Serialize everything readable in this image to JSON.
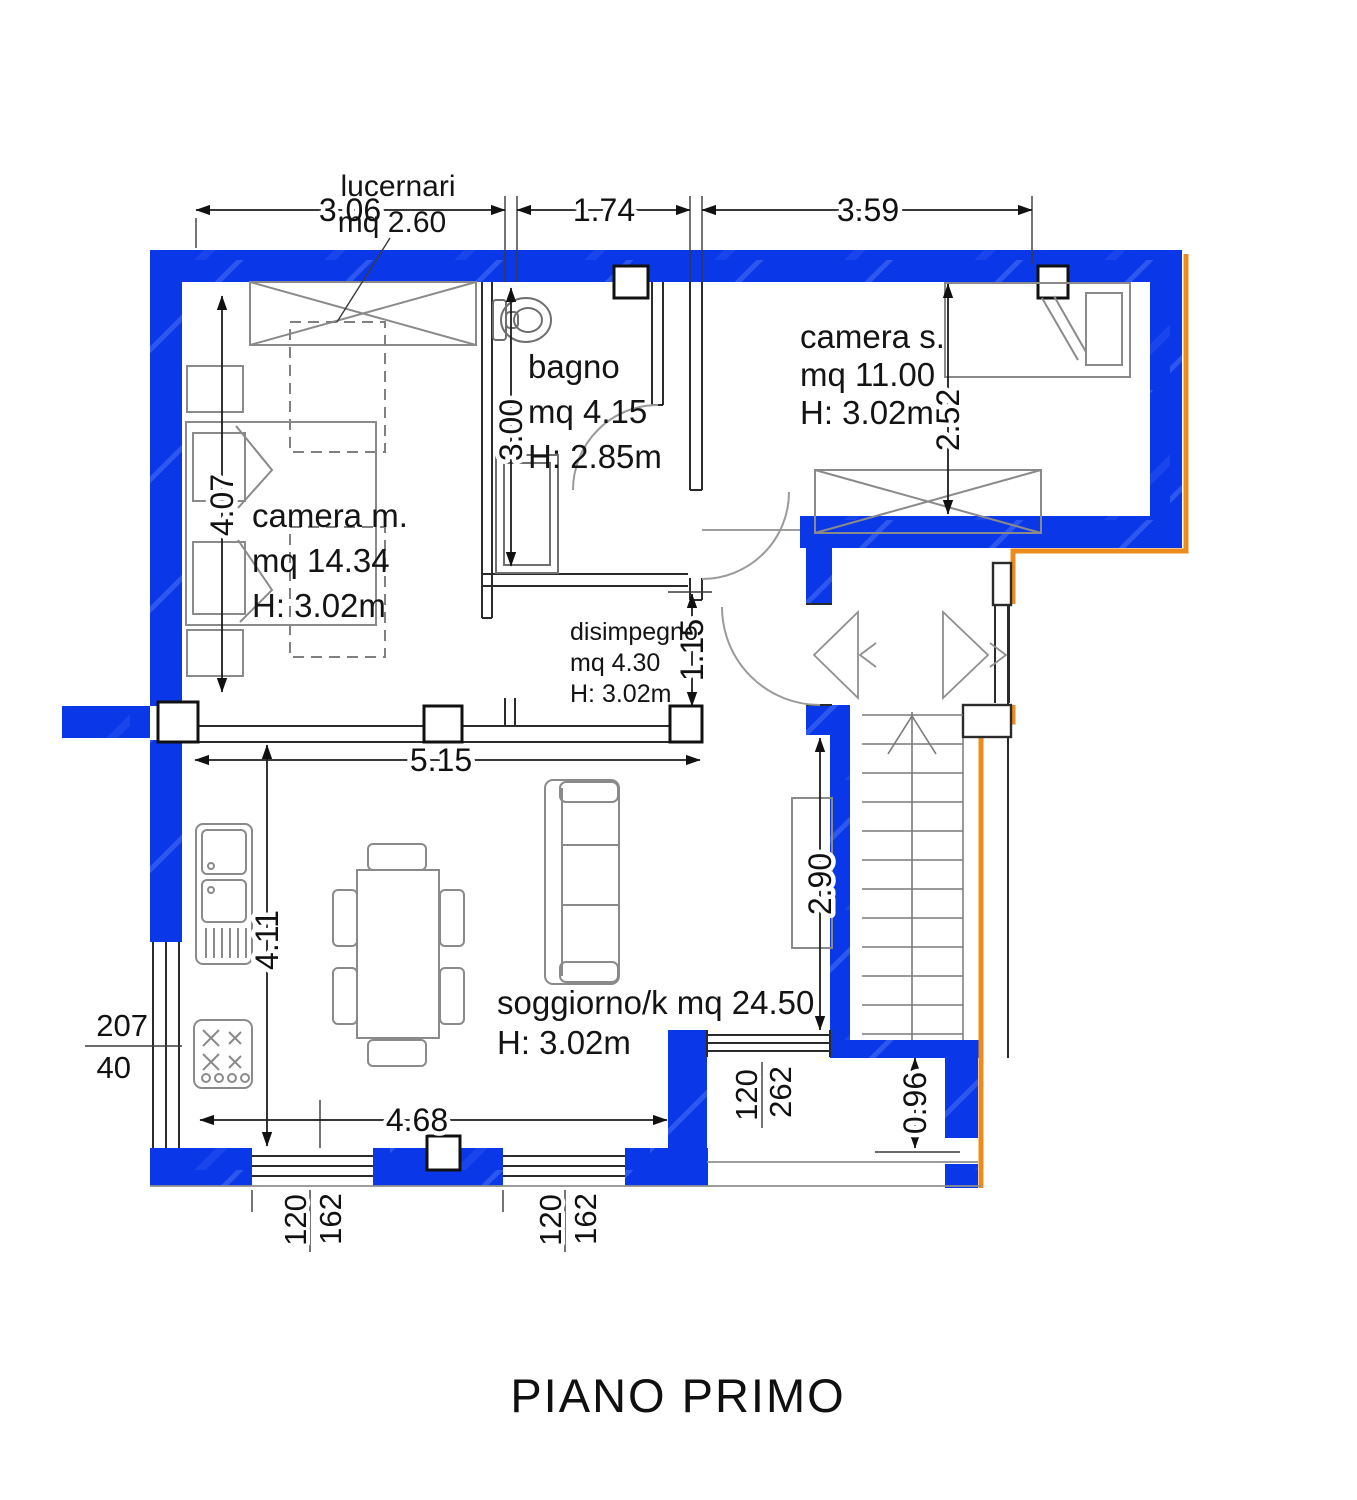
{
  "title": "PIANO PRIMO",
  "colors": {
    "wall_blue": "#0a37e8",
    "accent_orange": "#ec8c1f"
  },
  "skylight_label": {
    "line1": "lucernari",
    "line2": "mq 2.60"
  },
  "rooms": {
    "camera_m": {
      "name": "camera m.",
      "area": "mq 14.34",
      "height": "H: 3.02m"
    },
    "bagno": {
      "name": "bagno",
      "area": "mq 4.15",
      "height": "H: 2.85m"
    },
    "camera_s": {
      "name": "camera s.",
      "area": "mq 11.00",
      "height": "H: 3.02m"
    },
    "disimpegno": {
      "name": "disimpegno",
      "area": "mq 4.30",
      "height": "H: 3.02m"
    },
    "soggiorno": {
      "name_area": "soggiorno/k mq 24.50",
      "height": "H: 3.02m"
    }
  },
  "dimensions": {
    "top_left": "3.06",
    "top_mid": "1.74",
    "top_right": "3.59",
    "camera_m_side": "4.07",
    "bagno_side": "3.00",
    "camera_s_side": "2.52",
    "disimpegno_width": "5.15",
    "disimpegno_side": "1.15",
    "stair_side": "2.90",
    "soggiorno_side": "4.11",
    "soggiorno_width": "4.68",
    "balcony_side": "0.96"
  },
  "windows": {
    "kitchen": {
      "w": "207",
      "h": "40"
    },
    "balcony": {
      "w": "262",
      "h": "120"
    },
    "south1": {
      "w": "162",
      "h": "120"
    },
    "south2": {
      "w": "162",
      "h": "120"
    }
  }
}
